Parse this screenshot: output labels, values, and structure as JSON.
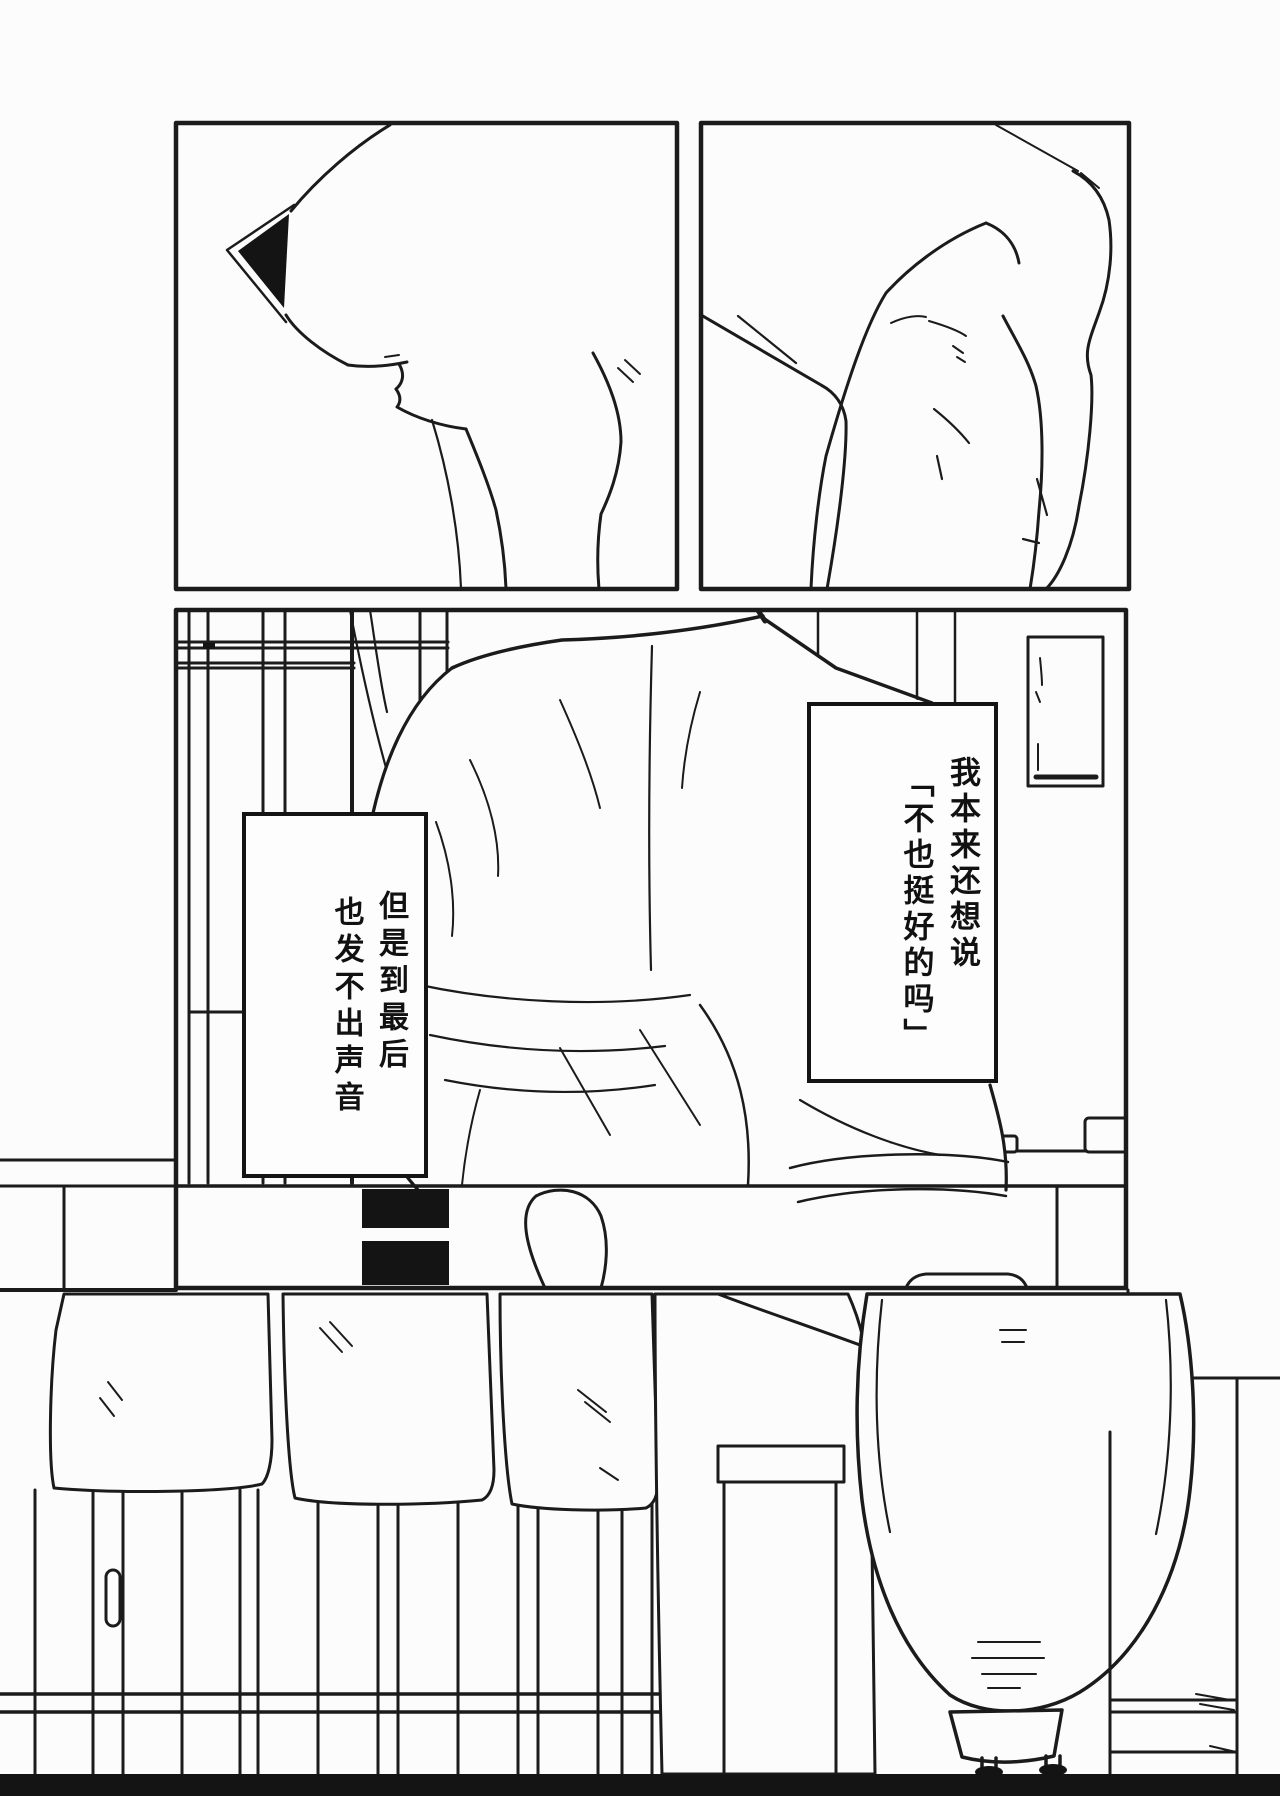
{
  "page": {
    "kind": "manga-page",
    "paper_color": "#fcfcfc",
    "ink_color": "#1b1b1b",
    "panel_count": 3
  },
  "panels": [
    {
      "id": "panel-top-left",
      "description": "close-up of a chin, mouth and neck in profile with dark eye shape"
    },
    {
      "id": "panel-top-right",
      "description": "close-up of a relaxed hand"
    },
    {
      "id": "panel-room",
      "description": "robed figure seated, seen from behind in a room with lattice window, hanging scroll and low table"
    }
  ],
  "speech": {
    "right_box": {
      "columns": [
        "我本来还想说",
        "「不也挺好的吗」"
      ]
    },
    "left_box": {
      "columns": [
        "但是到最后",
        "也发不出声音"
      ]
    }
  }
}
